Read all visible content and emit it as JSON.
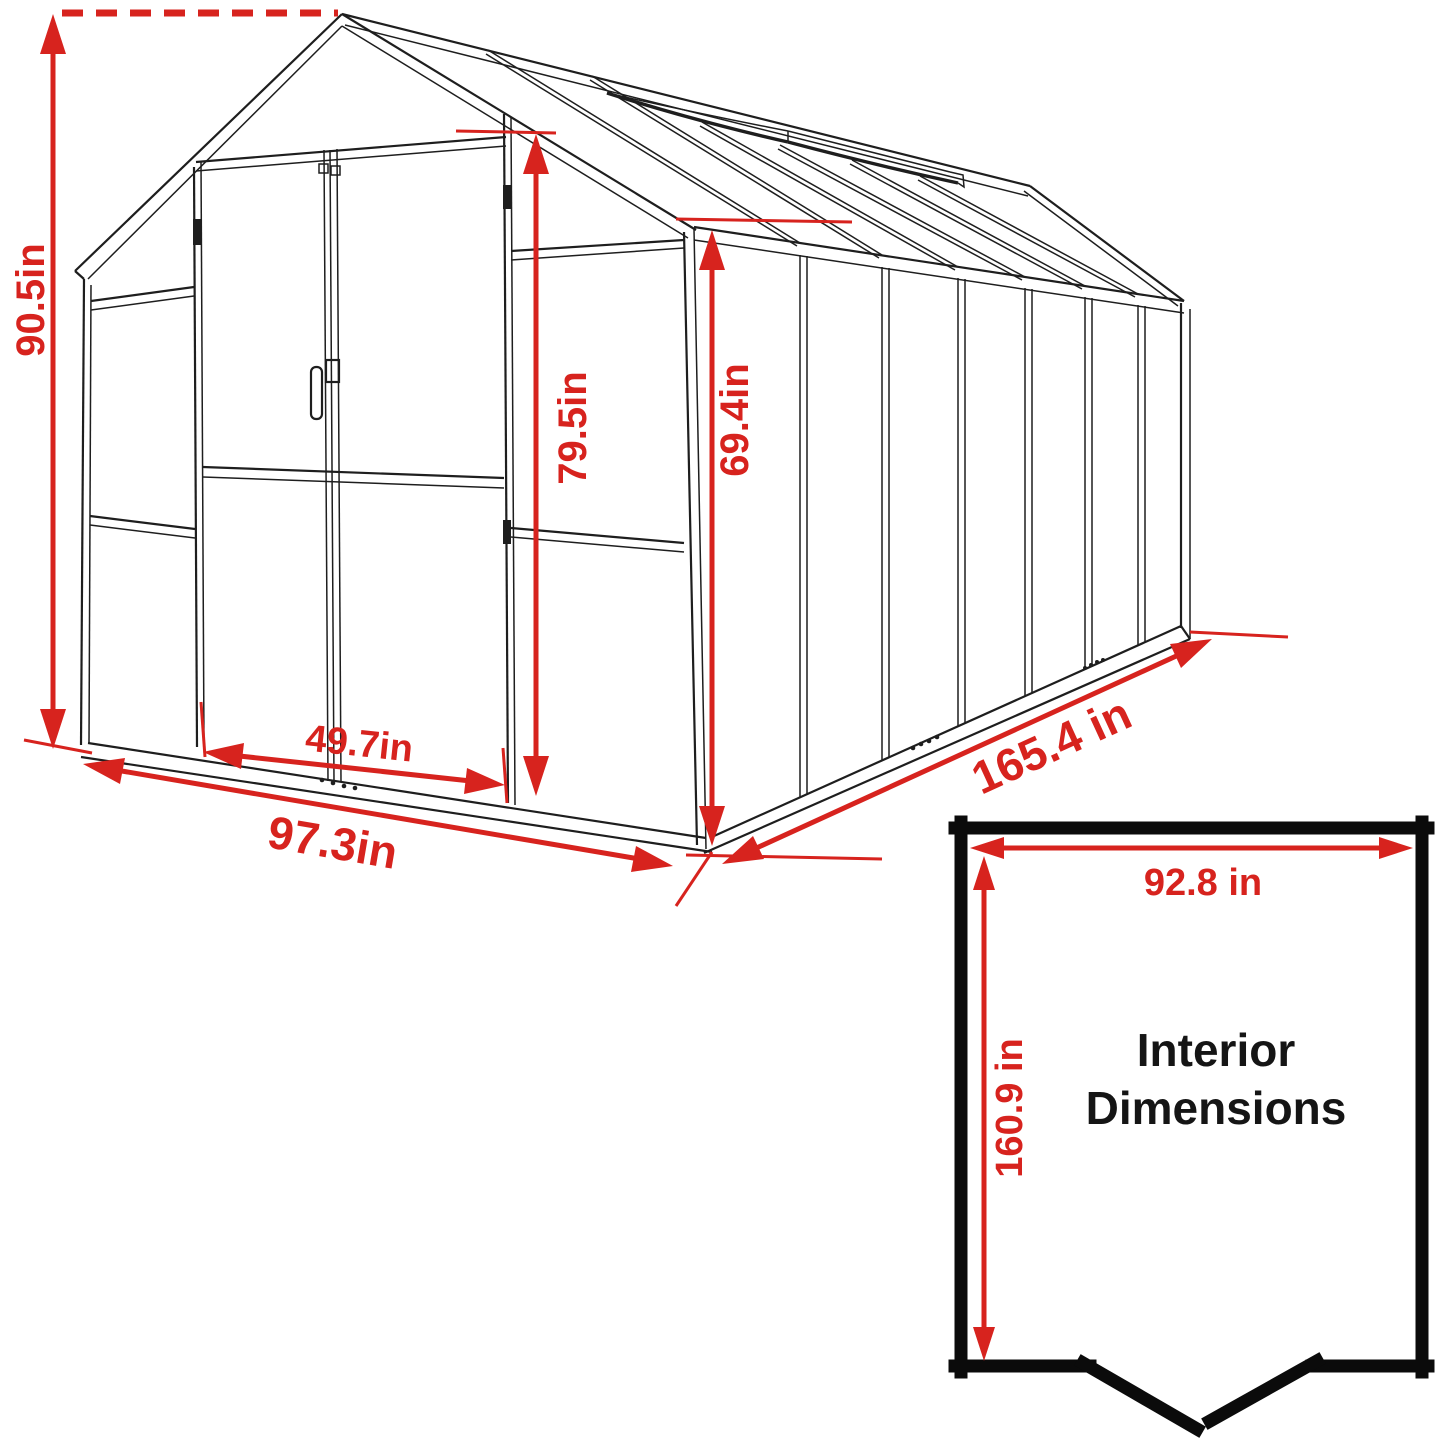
{
  "diagram": {
    "type": "greenhouse dimension line-drawing",
    "units": "in",
    "colors": {
      "dimension_red": "#d7231e",
      "outline_black": "#1e1e1e",
      "interior_border_black": "#0b0b0b",
      "background": "#ffffff"
    },
    "labels": {
      "overall_height": "90.5in",
      "door_height": "79.5in",
      "wall_height": "69.4in",
      "door_width": "49.7in",
      "front_width": "97.3in",
      "side_length": "165.4 in"
    },
    "interior_box": {
      "width": "92.8 in",
      "depth": "160.9 in",
      "title_line1": "Interior",
      "title_line2": "Dimensions"
    }
  }
}
